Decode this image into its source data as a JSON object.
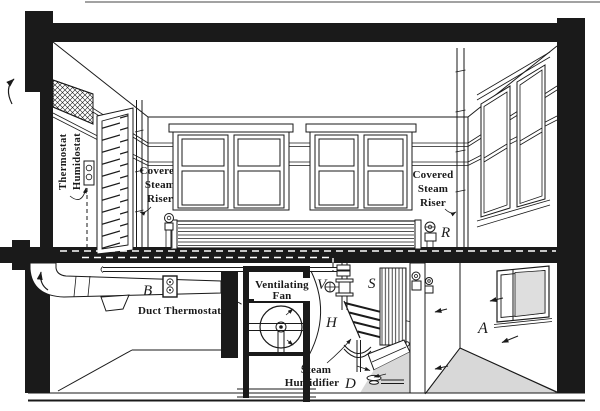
{
  "figure": {
    "type": "technical-illustration",
    "subject": "building cross-section with steam heating, humidification and ventilation system",
    "labels": {
      "thermostat1": "Thermostat",
      "thermostat2": "Humidostat",
      "riser_left": [
        "Covered",
        "Steam",
        "Riser"
      ],
      "riser_right": [
        "Covered",
        "Steam",
        "Riser"
      ],
      "duct_thermostat": "Duct Thermostat",
      "fan1": "Ventilating",
      "fan2": "Fan",
      "humid1": "Steam",
      "humid2": "Humidifier",
      "r": "R",
      "b": "B",
      "v": "V",
      "s": "S",
      "h": "H",
      "d": "D",
      "a": "A"
    },
    "colors": {
      "ink": "#1a1a1a",
      "background": "#ffffff",
      "floor_shade": "#d8d8d8",
      "glass_shade": "#dedede"
    }
  }
}
